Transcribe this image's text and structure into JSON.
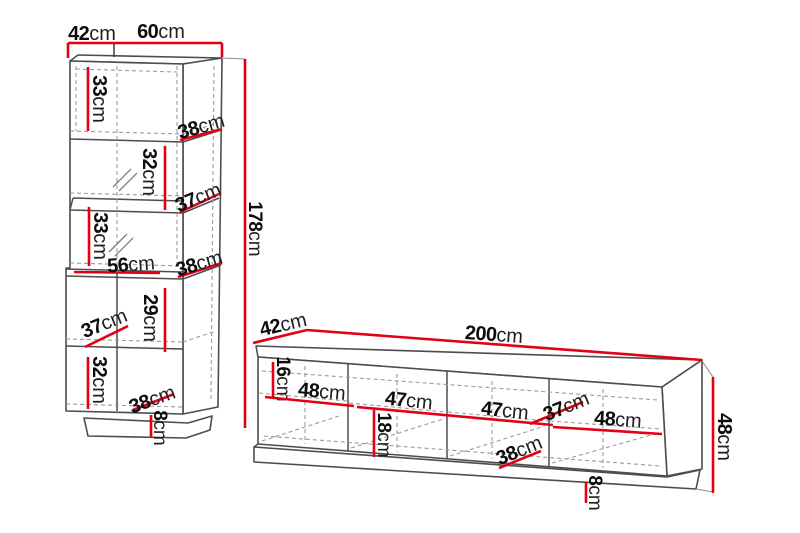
{
  "unit": "cm",
  "colors": {
    "dimension_red": "#e30015",
    "outline_gray": "#4d4d4d",
    "hidden_edge_gray": "#9a9a9a",
    "label_black": "#0d0d0d"
  },
  "cabinet": {
    "name": "tall display cabinet dimension drawing",
    "dims": {
      "top_depth": {
        "value": "42",
        "unit": "cm"
      },
      "top_width": {
        "value": "60",
        "unit": "cm"
      },
      "total_height": {
        "value": "178",
        "unit": "cm"
      },
      "s1_height": {
        "value": "33",
        "unit": "cm"
      },
      "s1_depth": {
        "value": "38",
        "unit": "cm"
      },
      "s2_height": {
        "value": "32",
        "unit": "cm"
      },
      "s2_depth": {
        "value": "37",
        "unit": "cm"
      },
      "s3_height": {
        "value": "33",
        "unit": "cm"
      },
      "s3_width": {
        "value": "56",
        "unit": "cm"
      },
      "s3_depth": {
        "value": "38",
        "unit": "cm"
      },
      "s4_height": {
        "value": "29",
        "unit": "cm"
      },
      "s4_depth": {
        "value": "37",
        "unit": "cm"
      },
      "s5_height": {
        "value": "32",
        "unit": "cm"
      },
      "s5_depth": {
        "value": "38",
        "unit": "cm"
      },
      "plinth_height": {
        "value": "8",
        "unit": "cm"
      }
    }
  },
  "tv_stand": {
    "name": "TV bench dimension drawing",
    "dims": {
      "depth": {
        "value": "42",
        "unit": "cm"
      },
      "total_width": {
        "value": "200",
        "unit": "cm"
      },
      "top_shelf_height": {
        "value": "16",
        "unit": "cm"
      },
      "bay1_width": {
        "value": "48",
        "unit": "cm"
      },
      "bay2_width": {
        "value": "47",
        "unit": "cm"
      },
      "bay3_width": {
        "value": "47",
        "unit": "cm"
      },
      "bay4_width": {
        "value": "48",
        "unit": "cm"
      },
      "lower_shelf_height": {
        "value": "18",
        "unit": "cm"
      },
      "inner_depth": {
        "value": "37",
        "unit": "cm"
      },
      "bottom_depth": {
        "value": "38",
        "unit": "cm"
      },
      "total_height": {
        "value": "48",
        "unit": "cm"
      },
      "plinth_height": {
        "value": "8",
        "unit": "cm"
      }
    }
  }
}
